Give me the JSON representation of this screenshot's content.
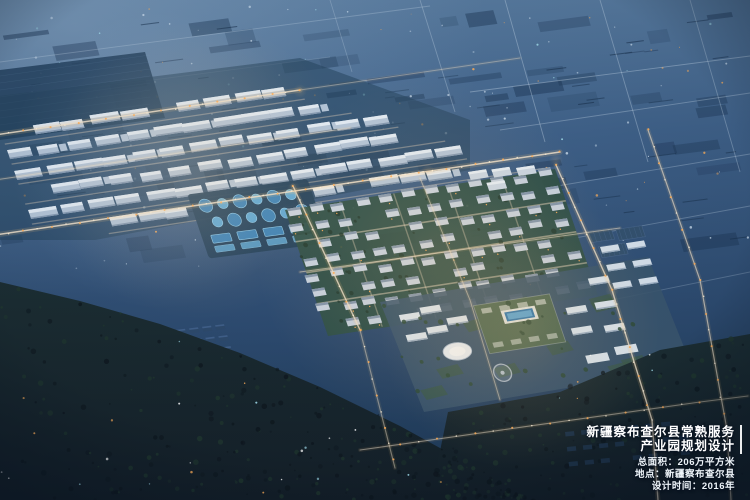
{
  "caption": {
    "title_line1": "新疆察布查尔县常熟服务",
    "title_line2": "产业园规划设计",
    "stats": [
      "总面积：206万平方米",
      "地点：新疆察布查尔县",
      "设计时间：2016年"
    ]
  },
  "scene": {
    "description": "night aerial rendering of planned industrial park and town",
    "palette": {
      "skyTop": "#5c7fa3",
      "skyMid": "#3f6189",
      "skyLow": "#2d4b70",
      "ground": "#1f3a57",
      "hazeBlue": "#a9c2da",
      "distantPatch": "#1c3553",
      "roadCool": "#c8daeb",
      "roadWarm": "#f2e3cd",
      "glowWarm": "#ffc97e",
      "streetlight": "#ffaf5a",
      "lightWhite": "#fff3dc",
      "lightCyan": "#9fd9e8",
      "fieldDark": "#24425f",
      "warehouseBody": "#b5c6d9",
      "warehouseRoof": "#e4edf6",
      "warehouseShade": "#8499b2",
      "pondPad": "#23425e",
      "pondBlue": "#3d84ba",
      "pondLight": "#5fa9d6",
      "pondRim": "#8ecbec",
      "resGreen": "#2f5046",
      "resBody": "#c9d4e1",
      "resRoof": "#8497ad",
      "streetWarm": "#e9d6bd",
      "officeBody": "#dee8f1",
      "officeShade": "#9fb2c6",
      "greenRoof": "#4c6853",
      "poolBlue": "#2c77b1",
      "poolLight": "#58a6d8",
      "ovalWhite": "#ebf1f7",
      "plazaStroke": "#c3cfdd",
      "hallNavy": "#34526f",
      "villageNavy": "#2e4a6b",
      "villageRoof": "#40608a",
      "villageDim": "#223a54",
      "forestA": "#141f28",
      "forestB": "#1c2e33",
      "treeDark": "#0e171e",
      "treeGreen": "#21392f",
      "vignette": "#071220"
    }
  }
}
